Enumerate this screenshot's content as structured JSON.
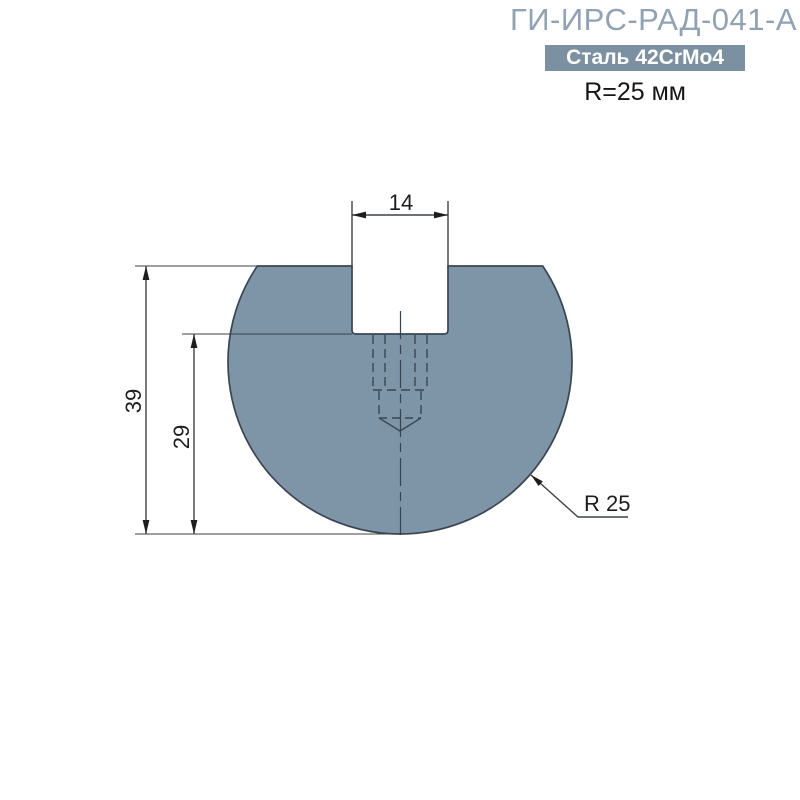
{
  "header": {
    "title": "ГИ-ИРС-РАД-041-А",
    "material_badge": "Сталь 42CrMo4",
    "radius_note": "R=25 мм"
  },
  "drawing": {
    "dimensions": {
      "slot_width": "14",
      "total_height": "39",
      "body_height": "29",
      "radius_callout": "R 25"
    }
  },
  "colors": {
    "title_text": "#8FA3B4",
    "badge_background": "#7B90A1",
    "badge_text": "#FFFFFF",
    "body_fill": "#7E95A8",
    "body_outline": "#3A4551",
    "hidden_line": "#394751",
    "dimension_line": "#3F4246",
    "dimension_text": "#1D1D1D"
  }
}
